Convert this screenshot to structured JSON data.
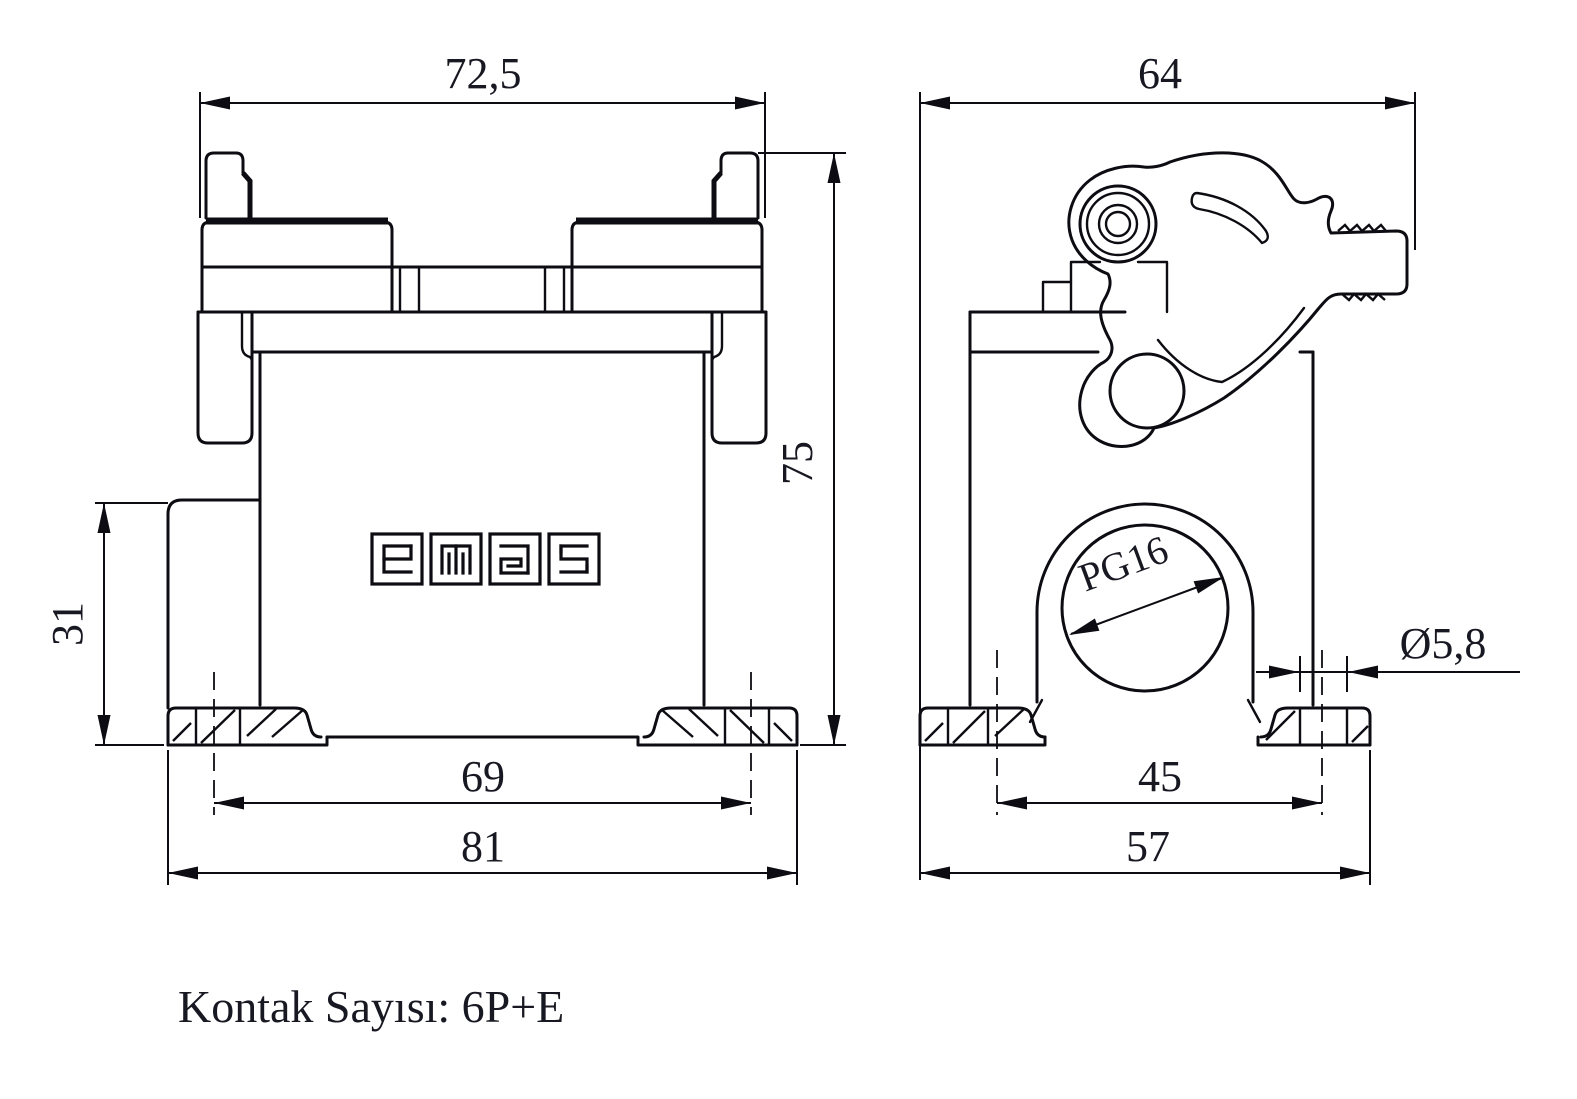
{
  "note": {
    "text": "Kontak Sayısı: 6P+E"
  },
  "brand_logo": "emas",
  "dims": {
    "front_width": "72,5",
    "front_height": "75",
    "boss_height": "31",
    "front_hole_spacing": "69",
    "front_base_width": "81",
    "side_width": "64",
    "side_hole_spacing": "45",
    "side_base_width": "57",
    "cable_gland": "PG16",
    "mount_hole_dia": "Ø5,8"
  },
  "colors": {
    "line": "#0c0c12",
    "text": "#181822",
    "bg": "#ffffff"
  }
}
